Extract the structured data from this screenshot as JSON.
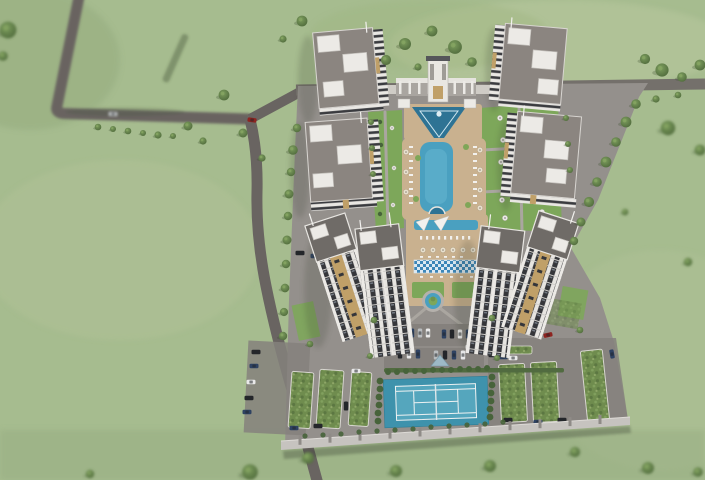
{
  "scene": {
    "type": "aerial 3D architectural rendering",
    "subject": "gated residential apartment complex with landscaped central courtyard",
    "surroundings": "open green fields with scattered trees and an access road from the top left",
    "features": [
      {
        "name": "apartment-buildings",
        "count": 8,
        "style": "gray roofs, white facades, dark window bands, gold accent strips, rooftop terraces"
      },
      {
        "name": "entrance-gate",
        "style": "white colonnade with central tower on north side"
      },
      {
        "name": "water-cascade-feature",
        "shape": "triangular basin below entrance gate"
      },
      {
        "name": "main-swimming-pool",
        "shape": "elongated pool with round spa at south end, flanked by sun loungers and umbrellas"
      },
      {
        "name": "secondary-pool",
        "detail": "small pool with white shade sails between the tall towers"
      },
      {
        "name": "mosaic-pool-band",
        "style": "blue and white tiled strip with loungers"
      },
      {
        "name": "fountain-roundabout",
        "detail": "circular pool ring with palm centerpiece"
      },
      {
        "name": "garden-seating-areas",
        "detail": "round tables with parasols on lawns"
      },
      {
        "name": "tennis-court",
        "color": "teal with white markings, hedge screen"
      },
      {
        "name": "parking-lots",
        "count": 3
      },
      {
        "name": "green-roof-carports",
        "count": 6
      },
      {
        "name": "perimeter-wall",
        "detail": "light gray wall with pillars along south edge"
      },
      {
        "name": "cars",
        "count": 34
      }
    ]
  },
  "colors": {
    "grass": "#a6bc8f",
    "grassLight": "#bfcca4",
    "grassDark": "#8fa878",
    "road": "#696461",
    "roadLight": "#74706b",
    "paving": "#94908c",
    "pavingDark": "#85817d",
    "wallTop": "#c6c3bf",
    "roof": "#8b8580",
    "roofDark": "#6f6b67",
    "wallWhite": "#eceae6",
    "windowDark": "#35363a",
    "accentTan": "#c0a068",
    "pool": "#4aa0c0",
    "poolDark": "#2e7394",
    "deck": "#c9b18f",
    "lawn": "#7da75a",
    "tree": "#5f8248",
    "treeDark": "#47633a",
    "courtOuter": "#3e92ac",
    "courtInner": "#55a6bd",
    "lineWhite": "#eef2f2",
    "planter": "#6f8c4e",
    "carWhite": "#e9e9e9",
    "carBlack": "#24262a",
    "carBlue": "#2e4262",
    "carRed": "#8e2420",
    "carSilver": "#b9bcbe"
  }
}
